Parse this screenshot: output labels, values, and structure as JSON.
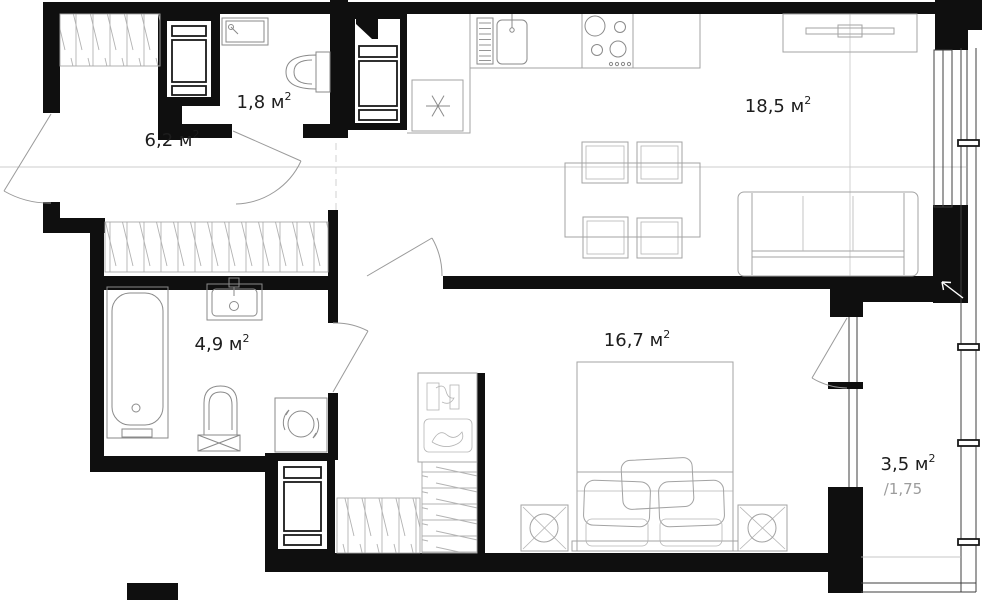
{
  "plan": {
    "type": "apartment-floor-plan",
    "colors": {
      "background": "#ffffff",
      "walls": "#0f0f0f",
      "furniture_line": "#a3a3a3",
      "fixture_line": "#8a8a8a",
      "label": "#1d1d1d",
      "muted_label": "#9c9c9c"
    },
    "rooms": [
      {
        "id": "entry-hall",
        "area_label": "6,2 м",
        "area_sup": "2"
      },
      {
        "id": "wc",
        "area_label": "1,8 м",
        "area_sup": "2"
      },
      {
        "id": "kitchen-living-room",
        "area_label": "18,5 м",
        "area_sup": "2"
      },
      {
        "id": "bathroom",
        "area_label": "4,9 м",
        "area_sup": "2"
      },
      {
        "id": "bedroom",
        "area_label": "16,7 м",
        "area_sup": "2"
      },
      {
        "id": "balcony",
        "area_label": "3,5 м",
        "area_sup": "2",
        "reduced_area_label": "/1,75"
      }
    ]
  }
}
